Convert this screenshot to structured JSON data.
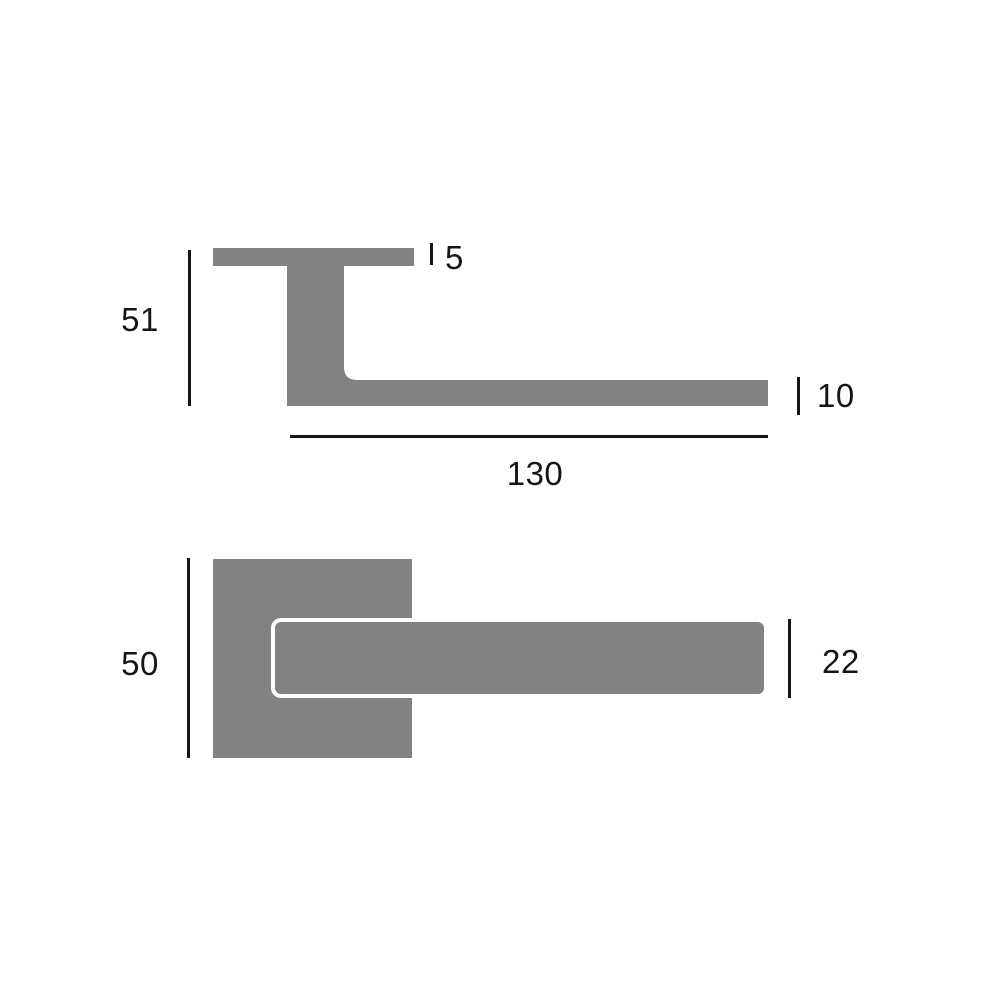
{
  "diagram": {
    "type": "technical-dimension-drawing",
    "subject": "lever door handle with square rose, two orthographic views",
    "colors": {
      "shape_fill": "#828282",
      "line_color": "#161616",
      "background": "#ffffff",
      "lever_front_outline": "#ffffff"
    },
    "side_view": {
      "dimensions": {
        "overall_height": "51",
        "rose_thickness": "5",
        "lever_length": "130",
        "lever_thickness": "10"
      }
    },
    "front_view": {
      "dimensions": {
        "rose_size": "50",
        "lever_width": "22"
      }
    }
  }
}
